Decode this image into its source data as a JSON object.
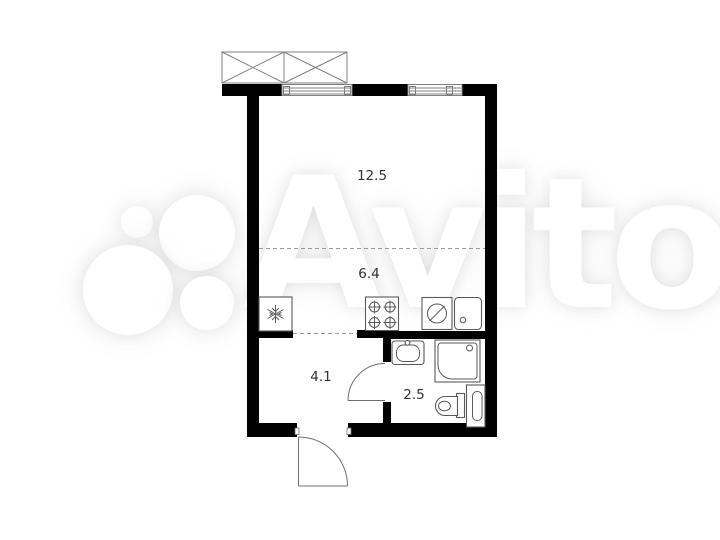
{
  "watermark": {
    "text": "Avito"
  },
  "rooms": [
    {
      "name": "living-room",
      "area_label": "12.5"
    },
    {
      "name": "kitchen",
      "area_label": "6.4"
    },
    {
      "name": "hallway",
      "area_label": "4.1"
    },
    {
      "name": "bathroom",
      "area_label": "2.5"
    }
  ],
  "fixtures": [
    "balcony-icon",
    "window-icon",
    "fridge-icon",
    "stove-icon",
    "washing-machine-icon",
    "kitchen-sink-icon",
    "bathroom-sink-icon",
    "shower-icon",
    "toilet-icon",
    "utility-cabinet-icon",
    "door-swing-icon"
  ],
  "colors": {
    "wall": "#000000",
    "outline": "#5a5a5a",
    "thin": "#808080",
    "dash": "#9a9a9a",
    "label": "#333333",
    "background": "#ffffff"
  }
}
